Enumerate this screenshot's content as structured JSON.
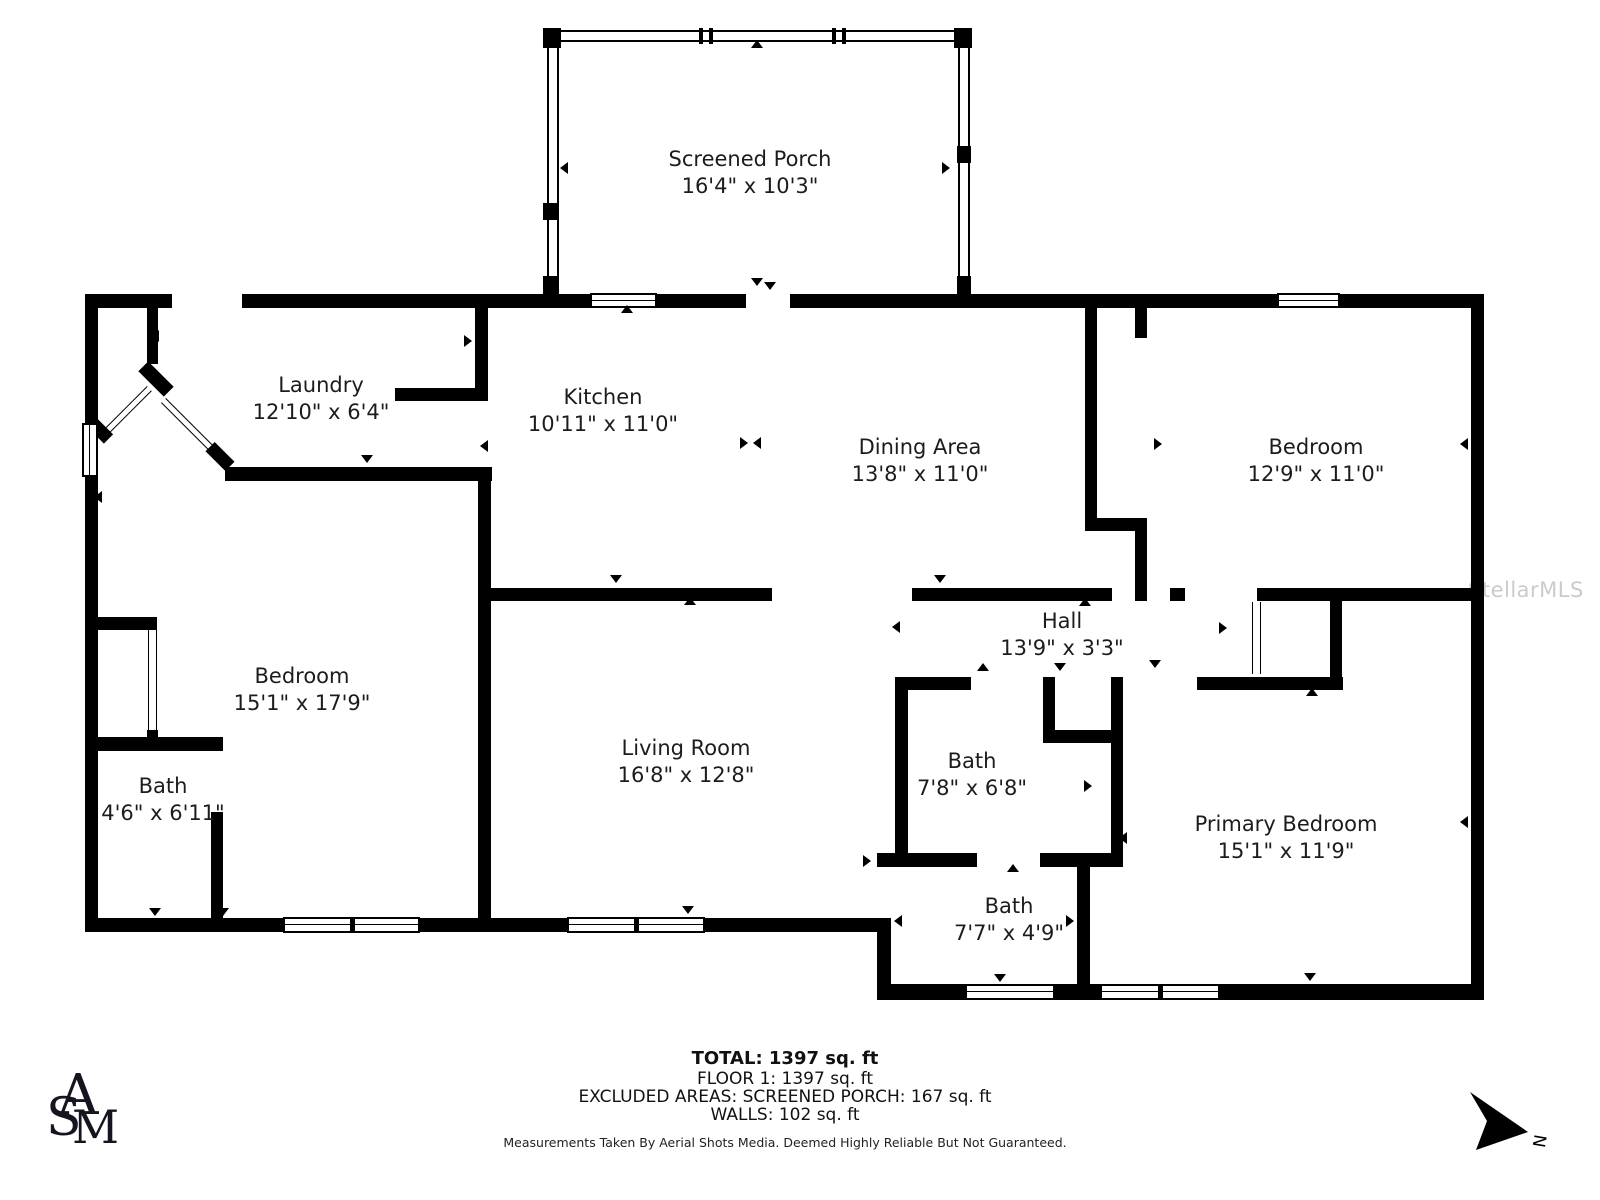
{
  "title": "Floor plan",
  "colors": {
    "wall": "#000000",
    "text": "#1c1c1c",
    "watermark": "#cbcbcb"
  },
  "watermark": "StellarMLS",
  "compass": {
    "label": "N"
  },
  "logo": {
    "letters": [
      "A",
      "S",
      "M"
    ]
  },
  "rooms": [
    {
      "name": "Screened Porch",
      "dims": "16'4\" x 10'3\"",
      "x": 750,
      "y": 146
    },
    {
      "name": "Laundry",
      "dims": "12'10\" x 6'4\"",
      "x": 321,
      "y": 372
    },
    {
      "name": "Kitchen",
      "dims": "10'11\" x 11'0\"",
      "x": 603,
      "y": 384
    },
    {
      "name": "Dining Area",
      "dims": "13'8\" x 11'0\"",
      "x": 920,
      "y": 434
    },
    {
      "name": "Bedroom",
      "dims": "12'9\" x 11'0\"",
      "x": 1316,
      "y": 434
    },
    {
      "name": "Bedroom",
      "dims": "15'1\" x 17'9\"",
      "x": 302,
      "y": 663
    },
    {
      "name": "Bath",
      "dims": "4'6\" x 6'11\"",
      "x": 163,
      "y": 773
    },
    {
      "name": "Living Room",
      "dims": "16'8\" x 12'8\"",
      "x": 686,
      "y": 735
    },
    {
      "name": "Hall",
      "dims": "13'9\" x 3'3\"",
      "x": 1062,
      "y": 608
    },
    {
      "name": "Bath",
      "dims": "7'8\" x 6'8\"",
      "x": 972,
      "y": 748
    },
    {
      "name": "Bath",
      "dims": "7'7\" x 4'9\"",
      "x": 1009,
      "y": 893
    },
    {
      "name": "Primary Bedroom",
      "dims": "15'1\" x 11'9\"",
      "x": 1286,
      "y": 811
    }
  ],
  "footer": {
    "total": "TOTAL: 1397 sq. ft",
    "floor": "FLOOR 1: 1397 sq. ft",
    "excluded": "EXCLUDED AREAS: SCREENED PORCH: 167 sq. ft",
    "walls": "WALLS: 102 sq. ft",
    "disclaimer": "Measurements Taken By Aerial Shots Media. Deemed Highly Reliable But Not Guaranteed."
  },
  "floorplan": {
    "walls": [
      [
        85,
        294,
        87,
        14
      ],
      [
        242,
        294,
        348,
        14
      ],
      [
        657,
        294,
        89,
        14
      ],
      [
        790,
        294,
        487,
        14
      ],
      [
        1340,
        294,
        144,
        14
      ],
      [
        85,
        294,
        13,
        130
      ],
      [
        85,
        477,
        13,
        441
      ],
      [
        85,
        918,
        198,
        14
      ],
      [
        420,
        918,
        147,
        14
      ],
      [
        705,
        918,
        186,
        14
      ],
      [
        877,
        918,
        14,
        82
      ],
      [
        877,
        984,
        93,
        16
      ],
      [
        1055,
        984,
        45,
        16
      ],
      [
        1220,
        984,
        264,
        16
      ],
      [
        1471,
        294,
        13,
        706
      ],
      [
        147,
        308,
        11,
        56
      ],
      [
        225,
        467,
        267,
        14
      ],
      [
        475,
        308,
        13,
        90
      ],
      [
        395,
        388,
        93,
        13
      ],
      [
        478,
        481,
        13,
        437
      ],
      [
        491,
        588,
        281,
        13
      ],
      [
        912,
        588,
        200,
        13
      ],
      [
        1085,
        308,
        12,
        210
      ],
      [
        1085,
        518,
        62,
        13
      ],
      [
        1135,
        308,
        12,
        30
      ],
      [
        1135,
        518,
        12,
        83
      ],
      [
        1170,
        588,
        15,
        13
      ],
      [
        1257,
        588,
        227,
        13
      ],
      [
        1330,
        588,
        12,
        102
      ],
      [
        1197,
        677,
        146,
        13
      ],
      [
        895,
        677,
        76,
        13
      ],
      [
        895,
        677,
        13,
        180
      ],
      [
        1043,
        677,
        12,
        66
      ],
      [
        1043,
        730,
        80,
        13
      ],
      [
        1111,
        677,
        12,
        176
      ],
      [
        877,
        853,
        100,
        14
      ],
      [
        1040,
        853,
        83,
        14
      ],
      [
        1077,
        853,
        13,
        147
      ],
      [
        97,
        617,
        60,
        13
      ],
      [
        147,
        730,
        11,
        14
      ],
      [
        85,
        737,
        138,
        14
      ],
      [
        211,
        737,
        12,
        14
      ],
      [
        211,
        812,
        12,
        106
      ]
    ],
    "screen_walls": [
      [
        546,
        30,
        424,
        12
      ],
      [
        547,
        30,
        12,
        265
      ],
      [
        958,
        30,
        12,
        265
      ]
    ],
    "posts": [
      [
        543,
        28,
        18,
        20
      ],
      [
        954,
        28,
        18,
        20
      ],
      [
        543,
        203,
        15,
        17
      ],
      [
        957,
        146,
        14,
        17
      ],
      [
        543,
        276,
        15,
        18
      ],
      [
        957,
        276,
        14,
        18
      ],
      [
        699,
        28,
        4,
        16
      ],
      [
        709,
        28,
        4,
        16
      ],
      [
        832,
        28,
        4,
        16
      ],
      [
        842,
        28,
        4,
        16
      ]
    ],
    "windows": [
      {
        "x": 590,
        "y": 293,
        "w": 67,
        "h": 15,
        "o": "h",
        "m": 0
      },
      {
        "x": 1277,
        "y": 293,
        "w": 63,
        "h": 15,
        "o": "h",
        "m": 0
      },
      {
        "x": 82,
        "y": 423,
        "w": 16,
        "h": 54,
        "o": "v",
        "m": 0
      },
      {
        "x": 283,
        "y": 917,
        "w": 137,
        "h": 16,
        "o": "h",
        "m": 1
      },
      {
        "x": 567,
        "y": 917,
        "w": 138,
        "h": 16,
        "o": "h",
        "m": 1
      },
      {
        "x": 965,
        "y": 984,
        "w": 90,
        "h": 16,
        "o": "h",
        "m": 0
      },
      {
        "x": 1100,
        "y": 984,
        "w": 120,
        "h": 16,
        "o": "h",
        "m": 1
      }
    ],
    "thin_doors": [
      [
        148,
        630,
        9,
        100
      ],
      [
        1252,
        602,
        9,
        72
      ]
    ],
    "diag_walls": [
      {
        "x": 138,
        "y": 372,
        "w": 36,
        "h": 14,
        "r": 45
      },
      {
        "x": 88,
        "y": 424,
        "w": 24,
        "h": 13,
        "r": 45
      },
      {
        "x": 206,
        "y": 450,
        "w": 28,
        "h": 13,
        "r": 45
      }
    ],
    "diag_doors": [
      {
        "x": 103,
        "y": 430,
        "w": 62,
        "h": 7,
        "r": -45
      },
      {
        "x": 166,
        "y": 398,
        "w": 70,
        "h": 7,
        "r": 45
      }
    ],
    "arrows": [
      {
        "x": 157,
        "y": 336,
        "d": "l"
      },
      {
        "x": 100,
        "y": 497,
        "d": "l"
      },
      {
        "x": 152,
        "y": 742,
        "d": "u"
      },
      {
        "x": 367,
        "y": 461,
        "d": "d"
      },
      {
        "x": 470,
        "y": 341,
        "d": "r"
      },
      {
        "x": 486,
        "y": 446,
        "d": "l"
      },
      {
        "x": 627,
        "y": 311,
        "d": "u"
      },
      {
        "x": 770,
        "y": 288,
        "d": "d"
      },
      {
        "x": 746,
        "y": 443,
        "d": "r"
      },
      {
        "x": 759,
        "y": 443,
        "d": "l"
      },
      {
        "x": 616,
        "y": 581,
        "d": "d"
      },
      {
        "x": 690,
        "y": 603,
        "d": "u"
      },
      {
        "x": 940,
        "y": 581,
        "d": "d"
      },
      {
        "x": 1085,
        "y": 604,
        "d": "u"
      },
      {
        "x": 898,
        "y": 627,
        "d": "l"
      },
      {
        "x": 1225,
        "y": 628,
        "d": "r"
      },
      {
        "x": 1060,
        "y": 669,
        "d": "d"
      },
      {
        "x": 1160,
        "y": 444,
        "d": "r"
      },
      {
        "x": 1466,
        "y": 444,
        "d": "l"
      },
      {
        "x": 1155,
        "y": 666,
        "d": "d"
      },
      {
        "x": 1312,
        "y": 694,
        "d": "u"
      },
      {
        "x": 983,
        "y": 669,
        "d": "u"
      },
      {
        "x": 903,
        "y": 786,
        "d": "l"
      },
      {
        "x": 1090,
        "y": 786,
        "d": "r"
      },
      {
        "x": 1125,
        "y": 838,
        "d": "l"
      },
      {
        "x": 1013,
        "y": 870,
        "d": "u"
      },
      {
        "x": 900,
        "y": 921,
        "d": "l"
      },
      {
        "x": 1072,
        "y": 921,
        "d": "r"
      },
      {
        "x": 1000,
        "y": 980,
        "d": "d"
      },
      {
        "x": 1310,
        "y": 979,
        "d": "d"
      },
      {
        "x": 1466,
        "y": 822,
        "d": "l"
      },
      {
        "x": 757,
        "y": 46,
        "d": "u"
      },
      {
        "x": 566,
        "y": 168,
        "d": "l"
      },
      {
        "x": 948,
        "y": 168,
        "d": "r"
      },
      {
        "x": 757,
        "y": 284,
        "d": "d"
      },
      {
        "x": 485,
        "y": 861,
        "d": "l"
      },
      {
        "x": 869,
        "y": 861,
        "d": "r"
      },
      {
        "x": 688,
        "y": 912,
        "d": "d"
      },
      {
        "x": 155,
        "y": 914,
        "d": "d"
      },
      {
        "x": 223,
        "y": 914,
        "d": "d"
      }
    ]
  }
}
